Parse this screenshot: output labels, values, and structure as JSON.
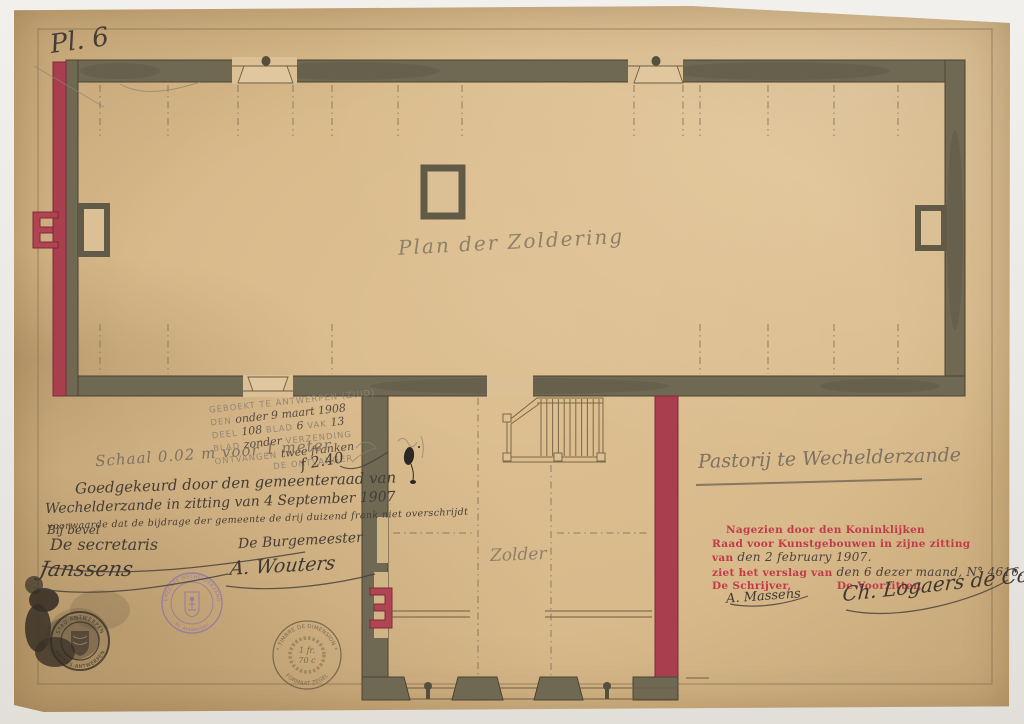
{
  "colors": {
    "paper": "#d8b98a",
    "wall": "#6f6853",
    "accent_red": "#a93f4e",
    "print_red": "#c13b4b",
    "stamp_purple": "#8f74ac",
    "ink": "#453d36",
    "pencil": "#8d8069"
  },
  "plate": {
    "label": "Pl. 6"
  },
  "plan_labels": {
    "attic": "Plan der Zoldering",
    "annex": "Zolder"
  },
  "title": {
    "text": "Pastorij te Wechelderzande"
  },
  "registration_stamp": {
    "line1": "GEBOEKT TE ANTWERPEN (ZUID)",
    "line2_print": "DEN",
    "line2_hand": "onder 9 maart 1908",
    "line3_print_a": "DEEL",
    "line3_hand_a": "108",
    "line3_print_b": "BLAD",
    "line3_hand_b": "6",
    "line3_print_c": "VAK",
    "line3_hand_c": "13",
    "line4_print_a": "BLAD",
    "line4_hand": "zonder",
    "line4_print_b": "VERZENDING",
    "line5_print": "ONTVANGEN",
    "line5_hand": "twee franken",
    "line6_print": "DE ONTVANGER",
    "fee_hand": "f 2.40"
  },
  "scale_note": "Schaal 0.02 m voor 1 meter",
  "approval": {
    "line1": "Goedgekeurd door den gemeenteraad van",
    "line2": "Wechelderzande in zitting van 4 September 1907",
    "condition": "voorwaarde dat de bijdrage der gemeente de drij duizend frank niet overschrijdt",
    "by_order": "Bij bevel",
    "secretary_label": "De secretaris",
    "secretary_signature": "Janssens",
    "mayor_label": "De Burgemeester",
    "mayor_signature": "A. Wouters"
  },
  "royal_board": {
    "line1": "Nagezien door den Koninklijken",
    "line2": "Raad voor Kunstgebouwen in zijne zitting",
    "line3_print": "van",
    "line3_hand": "den 2 february 1907.",
    "line4_print": "ziet het verslag van",
    "line4_hand": "den 6 dezer maand,",
    "line4_number": "N° 4616.",
    "writer_label": "De Schrijver,",
    "writer_signature": "A. Massens",
    "chair_label": "De Voorzitter,",
    "chair_signature": "Ch. Logaers de Cock"
  },
  "stamps": {
    "city": {
      "arc_top": "STAD ANTWERPEN",
      "arc_bottom": "ANVERS-ANTWERPEN"
    },
    "municipality": {
      "arc_top": "GEMEENTE WECHELDERZANDE",
      "arc_bottom": "· Pr. Antwerpen ·"
    },
    "dimension": {
      "arc_top": "* TIMBRE DE DIMENSION *",
      "arc_bottom": "FORMAAT ZEGEL",
      "value_top": "1 fr.",
      "value_bottom": "70 c"
    }
  }
}
